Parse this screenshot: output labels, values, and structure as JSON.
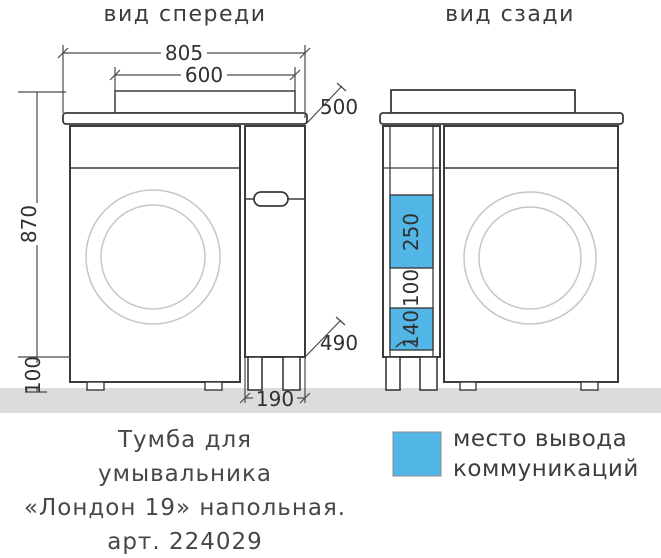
{
  "front_view": {
    "title": "вид спереди",
    "dim_top_width": "805",
    "dim_basin_width": "600",
    "dim_depth": "500",
    "dim_height": "870",
    "dim_leg_height": "100",
    "dim_niche_height": "490",
    "dim_column_width": "190"
  },
  "back_view": {
    "title": "вид сзади",
    "dim_cutout_top": "250",
    "dim_cutout_gap": "100",
    "dim_cutout_bottom": "140"
  },
  "caption": {
    "line1": "Тумба для",
    "line2": "умывальника",
    "line3": "«Лондон 19» напольная.",
    "line4": "арт. 224029"
  },
  "legend": {
    "line1": "место вывода",
    "line2": "коммуникаций"
  },
  "colors": {
    "accent_blue": "#52b6e6",
    "floor_gray": "#dcdcdc"
  }
}
